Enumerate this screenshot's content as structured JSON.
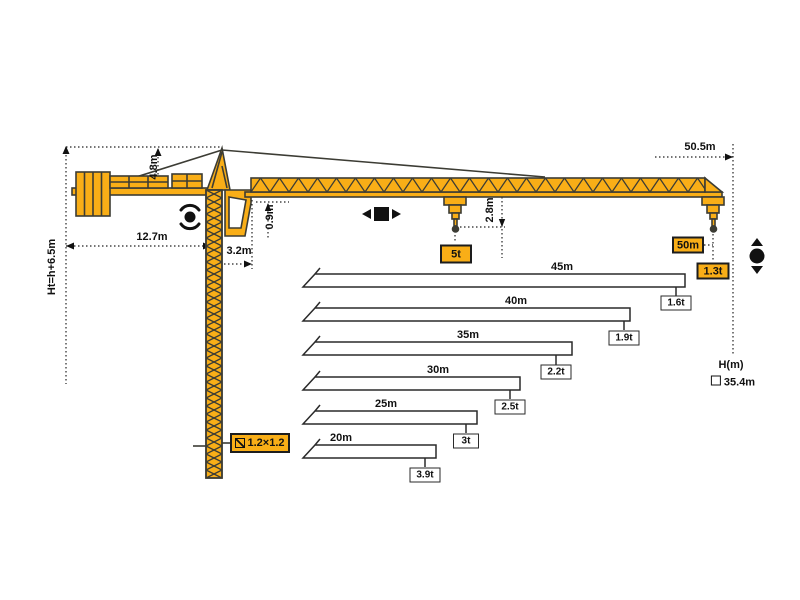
{
  "dimensions": {
    "total_height": "Ht=h+6.5m",
    "tower_head_height": "4.8m",
    "counter_jib_length": "12.7m",
    "slewing_offset": "3.2m",
    "jib_section_height": "0.9m",
    "hook_clearance": "2.8m",
    "max_working_radius": "50.5m"
  },
  "capacity_labels": {
    "max_capacity": "5t",
    "tip_radius": "50m",
    "tip_capacity": "1.3t"
  },
  "mast": {
    "section_size": "1.2×1.2"
  },
  "height_note": {
    "label": "H(m)",
    "value": "35.4m"
  },
  "load_chart": {
    "type": "bar",
    "rows": [
      {
        "length": "45m",
        "capacity": "1.6t",
        "length_m": 45,
        "capacity_t": 1.6
      },
      {
        "length": "40m",
        "capacity": "1.9t",
        "length_m": 40,
        "capacity_t": 1.9
      },
      {
        "length": "35m",
        "capacity": "2.2t",
        "length_m": 35,
        "capacity_t": 2.2
      },
      {
        "length": "30m",
        "capacity": "2.5t",
        "length_m": 30,
        "capacity_t": 2.5
      },
      {
        "length": "25m",
        "capacity": "3t",
        "length_m": 25,
        "capacity_t": 3
      },
      {
        "length": "20m",
        "capacity": "3.9t",
        "length_m": 20,
        "capacity_t": 3.9
      }
    ],
    "tip_point": {
      "length_m": 50,
      "capacity_t": 1.3
    },
    "max_point": {
      "capacity_t": 5
    }
  },
  "icons": {
    "slewing": "rotation-arrows",
    "trolley_travel": "left-right-arrows",
    "hoisting": "up-down-arrows"
  },
  "colors": {
    "crane_yellow": "#F9AE17",
    "outline": "#3C3C34",
    "dimension_line": "#222222",
    "bar_fill": "#FFFFFF"
  }
}
